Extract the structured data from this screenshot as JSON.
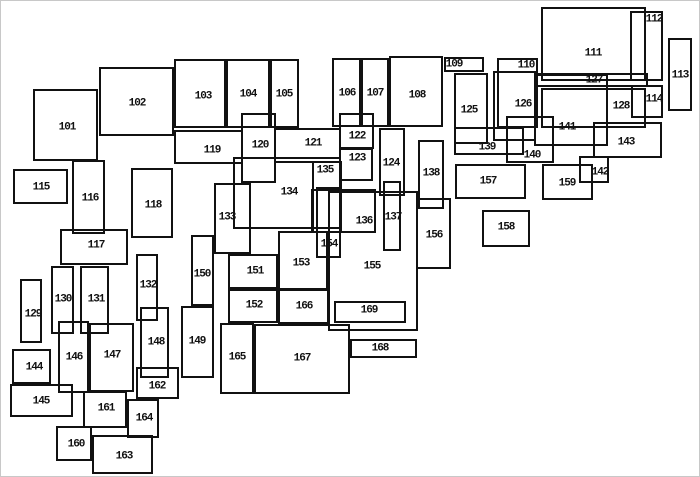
{
  "figure": {
    "description": "Index map of numbered overlapping rectangles",
    "background_color": "#ffffff",
    "line_color": "#111111",
    "width": 700,
    "height": 477,
    "boxes": [
      {
        "label": "101",
        "x": 32,
        "y": 88,
        "w": 65,
        "h": 72,
        "lx": 66,
        "ly": 127
      },
      {
        "label": "102",
        "x": 98,
        "y": 66,
        "w": 75,
        "h": 69,
        "lx": 136,
        "ly": 103
      },
      {
        "label": "103",
        "x": 173,
        "y": 58,
        "w": 52,
        "h": 69,
        "lx": 202,
        "ly": 96
      },
      {
        "label": "104",
        "x": 225,
        "y": 58,
        "w": 44,
        "h": 69,
        "lx": 247,
        "ly": 94
      },
      {
        "label": "105",
        "x": 269,
        "y": 58,
        "w": 29,
        "h": 69,
        "lx": 283,
        "ly": 94
      },
      {
        "label": "106",
        "x": 331,
        "y": 57,
        "w": 29,
        "h": 69,
        "lx": 346,
        "ly": 93
      },
      {
        "label": "107",
        "x": 360,
        "y": 57,
        "w": 28,
        "h": 69,
        "lx": 374,
        "ly": 93
      },
      {
        "label": "108",
        "x": 388,
        "y": 55,
        "w": 54,
        "h": 71,
        "lx": 416,
        "ly": 95
      },
      {
        "label": "109",
        "x": 443,
        "y": 56,
        "w": 40,
        "h": 15,
        "lx": 453,
        "ly": 64
      },
      {
        "label": "110",
        "x": 496,
        "y": 57,
        "w": 41,
        "h": 70,
        "lx": 525,
        "ly": 65
      },
      {
        "label": "111",
        "x": 540,
        "y": 6,
        "w": 105,
        "h": 74,
        "lx": 592,
        "ly": 53
      },
      {
        "label": "112",
        "x": 629,
        "y": 10,
        "w": 33,
        "h": 70,
        "lx": 653,
        "ly": 19
      },
      {
        "label": "113",
        "x": 667,
        "y": 37,
        "w": 24,
        "h": 73,
        "lx": 679,
        "ly": 75
      },
      {
        "label": "114",
        "x": 630,
        "y": 84,
        "w": 32,
        "h": 33,
        "lx": 653,
        "ly": 99
      },
      {
        "label": "115",
        "x": 12,
        "y": 168,
        "w": 55,
        "h": 35,
        "lx": 40,
        "ly": 187
      },
      {
        "label": "116",
        "x": 71,
        "y": 159,
        "w": 33,
        "h": 74,
        "lx": 89,
        "ly": 198
      },
      {
        "label": "117",
        "x": 59,
        "y": 228,
        "w": 68,
        "h": 36,
        "lx": 95,
        "ly": 245
      },
      {
        "label": "118",
        "x": 130,
        "y": 167,
        "w": 42,
        "h": 70,
        "lx": 152,
        "ly": 205
      },
      {
        "label": "119",
        "x": 173,
        "y": 129,
        "w": 69,
        "h": 34,
        "lx": 211,
        "ly": 150
      },
      {
        "label": "120",
        "x": 240,
        "y": 112,
        "w": 35,
        "h": 70,
        "lx": 259,
        "ly": 145
      },
      {
        "label": "121",
        "x": 273,
        "y": 127,
        "w": 67,
        "h": 35,
        "lx": 312,
        "ly": 143
      },
      {
        "label": "122",
        "x": 338,
        "y": 112,
        "w": 35,
        "h": 36,
        "lx": 356,
        "ly": 136
      },
      {
        "label": "123",
        "x": 338,
        "y": 147,
        "w": 34,
        "h": 33,
        "lx": 356,
        "ly": 158
      },
      {
        "label": "124",
        "x": 378,
        "y": 127,
        "w": 26,
        "h": 68,
        "lx": 390,
        "ly": 163
      },
      {
        "label": "125",
        "x": 453,
        "y": 72,
        "w": 34,
        "h": 71,
        "lx": 468,
        "ly": 110
      },
      {
        "label": "126",
        "x": 492,
        "y": 70,
        "w": 43,
        "h": 70,
        "lx": 522,
        "ly": 104
      },
      {
        "label": "127",
        "x": 534,
        "y": 72,
        "w": 113,
        "h": 14,
        "lx": 593,
        "ly": 80
      },
      {
        "label": "128",
        "x": 540,
        "y": 87,
        "w": 105,
        "h": 40,
        "lx": 620,
        "ly": 106
      },
      {
        "label": "129",
        "x": 19,
        "y": 278,
        "w": 22,
        "h": 64,
        "lx": 32,
        "ly": 314
      },
      {
        "label": "130",
        "x": 50,
        "y": 265,
        "w": 23,
        "h": 68,
        "lx": 62,
        "ly": 299
      },
      {
        "label": "131",
        "x": 79,
        "y": 265,
        "w": 29,
        "h": 68,
        "lx": 95,
        "ly": 299
      },
      {
        "label": "132",
        "x": 135,
        "y": 253,
        "w": 22,
        "h": 67,
        "lx": 147,
        "ly": 285
      },
      {
        "label": "133",
        "x": 213,
        "y": 182,
        "w": 37,
        "h": 71,
        "lx": 226,
        "ly": 217
      },
      {
        "label": "134",
        "x": 232,
        "y": 156,
        "w": 108,
        "h": 72,
        "lx": 288,
        "ly": 192
      },
      {
        "label": "135",
        "x": 311,
        "y": 160,
        "w": 30,
        "h": 72,
        "lx": 324,
        "ly": 170
      },
      {
        "label": "136",
        "x": 310,
        "y": 188,
        "w": 65,
        "h": 44,
        "lx": 363,
        "ly": 221
      },
      {
        "label": "137",
        "x": 382,
        "y": 180,
        "w": 18,
        "h": 70,
        "lx": 392,
        "ly": 217
      },
      {
        "label": "138",
        "x": 417,
        "y": 139,
        "w": 26,
        "h": 69,
        "lx": 430,
        "ly": 173
      },
      {
        "label": "139",
        "x": 453,
        "y": 126,
        "w": 70,
        "h": 28,
        "lx": 486,
        "ly": 147
      },
      {
        "label": "140",
        "x": 505,
        "y": 115,
        "w": 48,
        "h": 47,
        "lx": 531,
        "ly": 155
      },
      {
        "label": "141",
        "x": 533,
        "y": 73,
        "w": 74,
        "h": 72,
        "lx": 566,
        "ly": 127
      },
      {
        "label": "142",
        "x": 578,
        "y": 155,
        "w": 30,
        "h": 27,
        "lx": 599,
        "ly": 172
      },
      {
        "label": "143",
        "x": 592,
        "y": 121,
        "w": 69,
        "h": 36,
        "lx": 625,
        "ly": 142
      },
      {
        "label": "144",
        "x": 11,
        "y": 348,
        "w": 39,
        "h": 35,
        "lx": 33,
        "ly": 367
      },
      {
        "label": "145",
        "x": 9,
        "y": 383,
        "w": 63,
        "h": 33,
        "lx": 40,
        "ly": 401
      },
      {
        "label": "146",
        "x": 57,
        "y": 320,
        "w": 31,
        "h": 72,
        "lx": 73,
        "ly": 357
      },
      {
        "label": "147",
        "x": 88,
        "y": 322,
        "w": 45,
        "h": 69,
        "lx": 111,
        "ly": 355
      },
      {
        "label": "148",
        "x": 139,
        "y": 306,
        "w": 29,
        "h": 71,
        "lx": 155,
        "ly": 342
      },
      {
        "label": "149",
        "x": 180,
        "y": 305,
        "w": 33,
        "h": 72,
        "lx": 196,
        "ly": 341
      },
      {
        "label": "150",
        "x": 190,
        "y": 234,
        "w": 23,
        "h": 71,
        "lx": 201,
        "ly": 274
      },
      {
        "label": "151",
        "x": 227,
        "y": 253,
        "w": 50,
        "h": 35,
        "lx": 254,
        "ly": 271
      },
      {
        "label": "152",
        "x": 227,
        "y": 288,
        "w": 50,
        "h": 34,
        "lx": 253,
        "ly": 305
      },
      {
        "label": "153",
        "x": 277,
        "y": 230,
        "w": 50,
        "h": 59,
        "lx": 300,
        "ly": 263
      },
      {
        "label": "154",
        "x": 315,
        "y": 186,
        "w": 25,
        "h": 71,
        "lx": 328,
        "ly": 244
      },
      {
        "label": "155",
        "x": 327,
        "y": 190,
        "w": 90,
        "h": 140,
        "lx": 371,
        "ly": 266
      },
      {
        "label": "156",
        "x": 415,
        "y": 197,
        "w": 35,
        "h": 71,
        "lx": 433,
        "ly": 235
      },
      {
        "label": "157",
        "x": 454,
        "y": 163,
        "w": 71,
        "h": 35,
        "lx": 487,
        "ly": 181
      },
      {
        "label": "158",
        "x": 481,
        "y": 209,
        "w": 48,
        "h": 37,
        "lx": 505,
        "ly": 227
      },
      {
        "label": "159",
        "x": 541,
        "y": 163,
        "w": 51,
        "h": 36,
        "lx": 566,
        "ly": 183
      },
      {
        "label": "160",
        "x": 55,
        "y": 425,
        "w": 36,
        "h": 35,
        "lx": 75,
        "ly": 444
      },
      {
        "label": "161",
        "x": 82,
        "y": 390,
        "w": 44,
        "h": 37,
        "lx": 105,
        "ly": 408
      },
      {
        "label": "162",
        "x": 135,
        "y": 366,
        "w": 43,
        "h": 32,
        "lx": 156,
        "ly": 386
      },
      {
        "label": "163",
        "x": 91,
        "y": 434,
        "w": 61,
        "h": 39,
        "lx": 123,
        "ly": 456
      },
      {
        "label": "164",
        "x": 126,
        "y": 398,
        "w": 32,
        "h": 39,
        "lx": 143,
        "ly": 418
      },
      {
        "label": "165",
        "x": 219,
        "y": 322,
        "w": 34,
        "h": 71,
        "lx": 236,
        "ly": 357
      },
      {
        "label": "166",
        "x": 277,
        "y": 288,
        "w": 51,
        "h": 35,
        "lx": 303,
        "ly": 306
      },
      {
        "label": "167",
        "x": 253,
        "y": 323,
        "w": 96,
        "h": 70,
        "lx": 301,
        "ly": 358
      },
      {
        "label": "168",
        "x": 349,
        "y": 338,
        "w": 67,
        "h": 19,
        "lx": 379,
        "ly": 348
      },
      {
        "label": "169",
        "x": 333,
        "y": 300,
        "w": 72,
        "h": 22,
        "lx": 368,
        "ly": 310
      }
    ]
  }
}
